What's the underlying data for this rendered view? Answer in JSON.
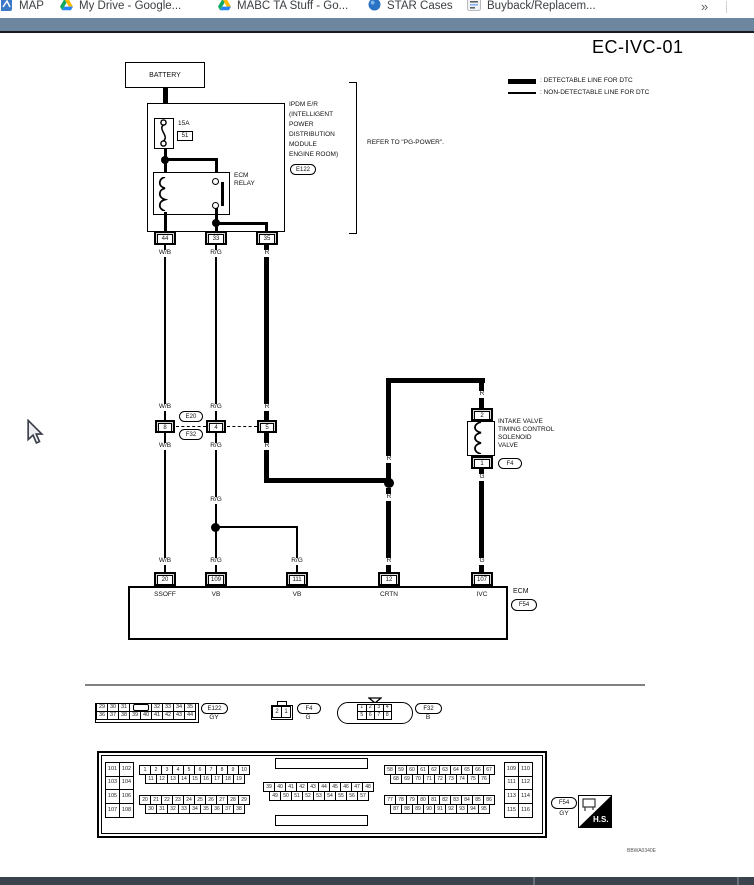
{
  "browser": {
    "bookmarks": [
      {
        "label": "MAP",
        "icon": "map-favicon"
      },
      {
        "label": "My Drive - Google...",
        "icon": "drive-icon"
      },
      {
        "label": "MABC TA Stuff - Go...",
        "icon": "drive-icon"
      },
      {
        "label": "STAR Cases",
        "icon": "globe-icon"
      },
      {
        "label": "Buyback/Replacem...",
        "icon": "doc-icon"
      }
    ],
    "overflow_chevron": "»"
  },
  "colors": {
    "toolbar_blue": "#6e87a0",
    "taskbar": "#3c434c",
    "diagram_line": "#000000"
  },
  "diagram": {
    "title": "EC-IVC-01",
    "legend": {
      "detectable": ": DETECTABLE LINE FOR DTC",
      "non_detectable": ": NON-DETECTABLE LINE FOR DTC"
    },
    "battery": "BATTERY",
    "ipdm": {
      "fuse_amp": "15A",
      "fuse_num": "51",
      "relay_line1": "ECM",
      "relay_line2": "RELAY",
      "name_lines": [
        "IPDM E/R",
        "(INTELLIGENT",
        "POWER",
        "DISTRIBUTION",
        "MODULE",
        "ENGINE ROOM)"
      ],
      "connector": "E122",
      "note": "REFER TO \"PG-POWER\".",
      "terminals": [
        "44",
        "33",
        "35"
      ]
    },
    "wires": {
      "wb": "W/B",
      "rg": "R/G",
      "r": "R",
      "g": "G"
    },
    "inline": {
      "top": "E20",
      "bottom": "F32",
      "pins": [
        "8",
        "4",
        "5"
      ]
    },
    "solenoid": {
      "pin_top": "2",
      "pin_bottom": "1",
      "name_lines": [
        "INTAKE VALVE",
        "TIMING CONTROL",
        "SOLENOID",
        "VALVE"
      ],
      "connector": "F4"
    },
    "ecm": {
      "label": "ECM",
      "connector": "F54",
      "terminals": [
        "20",
        "109",
        "111",
        "12",
        "107"
      ],
      "names": [
        "SSOFF",
        "VB",
        "VB",
        "CRTN",
        "IVC"
      ]
    },
    "code": "BBWA0340E"
  },
  "connectors": {
    "e122": {
      "id": "E122",
      "color": "GY",
      "row1": [
        "29",
        "30",
        "31",
        "",
        "32",
        "33",
        "34",
        "35"
      ],
      "row2": [
        "36",
        "37",
        "38",
        "39",
        "40",
        "41",
        "42",
        "43",
        "44"
      ]
    },
    "f4": {
      "id": "F4",
      "color": "G",
      "pins": [
        "2",
        "1"
      ]
    },
    "f32": {
      "id": "F32",
      "color": "B",
      "row1": [
        "1",
        "2",
        "3",
        "4"
      ],
      "row2": [
        "5",
        "6",
        "7",
        "8"
      ]
    },
    "f54": {
      "id": "F54",
      "color": "GY",
      "hs": "H.S.",
      "left": [
        "101",
        "102",
        "103",
        "104",
        "105",
        "106",
        "107",
        "108"
      ],
      "right": [
        "109",
        "110",
        "111",
        "112",
        "113",
        "114",
        "115",
        "116"
      ],
      "tl1": [
        "1",
        "2",
        "3",
        "4",
        "5",
        "6",
        "7",
        "8",
        "9",
        "10"
      ],
      "tl2": [
        "11",
        "12",
        "13",
        "14",
        "15",
        "16",
        "17",
        "18",
        "19"
      ],
      "bl1": [
        "20",
        "21",
        "22",
        "23",
        "24",
        "25",
        "26",
        "27",
        "28",
        "29"
      ],
      "bl2": [
        "30",
        "31",
        "32",
        "33",
        "34",
        "35",
        "36",
        "37",
        "38"
      ],
      "mid1": [
        "39",
        "40",
        "41",
        "42",
        "43",
        "44",
        "45",
        "46",
        "47",
        "48"
      ],
      "mid2": [
        "49",
        "50",
        "51",
        "52",
        "53",
        "54",
        "55",
        "56",
        "57"
      ],
      "tr1": [
        "58",
        "59",
        "60",
        "61",
        "62",
        "63",
        "64",
        "65",
        "66",
        "67"
      ],
      "tr2": [
        "68",
        "69",
        "70",
        "71",
        "72",
        "73",
        "74",
        "75",
        "76"
      ],
      "br1": [
        "77",
        "78",
        "79",
        "80",
        "81",
        "82",
        "83",
        "84",
        "85",
        "86"
      ],
      "br2": [
        "87",
        "88",
        "89",
        "90",
        "91",
        "92",
        "93",
        "94",
        "95"
      ]
    }
  }
}
